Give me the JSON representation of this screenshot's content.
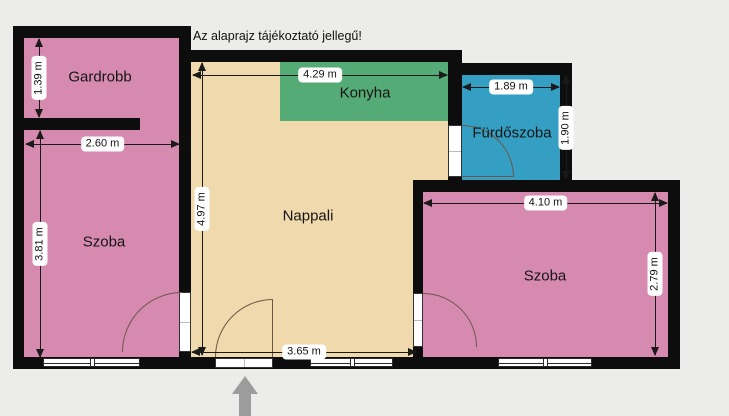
{
  "note": "Az alaprajz tájékoztató jellegű!",
  "rooms": {
    "gardrobb": {
      "label": "Gardrobb"
    },
    "szoba_left": {
      "label": "Szoba"
    },
    "nappali": {
      "label": "Nappali"
    },
    "konyha": {
      "label": "Konyha"
    },
    "furdoszoba": {
      "label": "Fürdőszoba"
    },
    "szoba_right": {
      "label": "Szoba"
    }
  },
  "dimensions": {
    "gardrobb_height": "1.39 m",
    "szoba_left_width": "2.60 m",
    "szoba_left_height": "3.81 m",
    "nappali_width": "4.29 m",
    "nappali_height": "4.97 m",
    "furdoszoba_width": "1.89 m",
    "furdoszoba_height": "1.90 m",
    "szoba_right_width": "4.10 m",
    "szoba_right_height": "2.79 m",
    "nappali_bottom_width": "3.65 m"
  },
  "colors": {
    "background": "#ececea",
    "wall": "#0d0d0d",
    "room_pink": "#d78ab0",
    "room_beige": "#f0d9ad",
    "room_green": "#55ab75",
    "room_blue": "#359fc3",
    "dimension_line": "#1a1a1a",
    "entrance_arrow": "#9c9c9c"
  }
}
